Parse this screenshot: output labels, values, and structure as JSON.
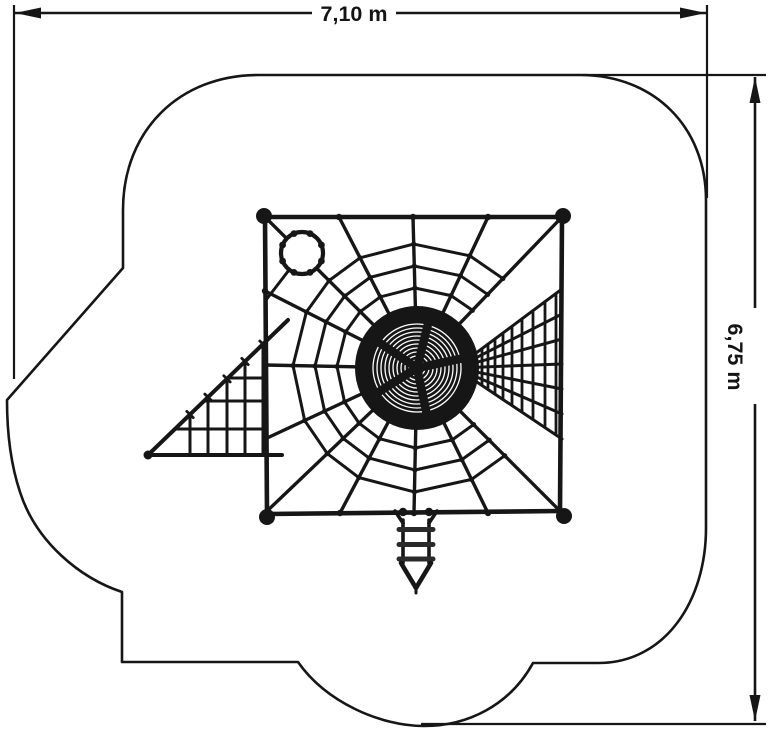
{
  "page": {
    "background": "#ffffff"
  },
  "drawing": {
    "ink_color": "#161616",
    "dimension_width": {
      "label": "7,10 m"
    },
    "dimension_height": {
      "label": "6,75 m"
    }
  }
}
